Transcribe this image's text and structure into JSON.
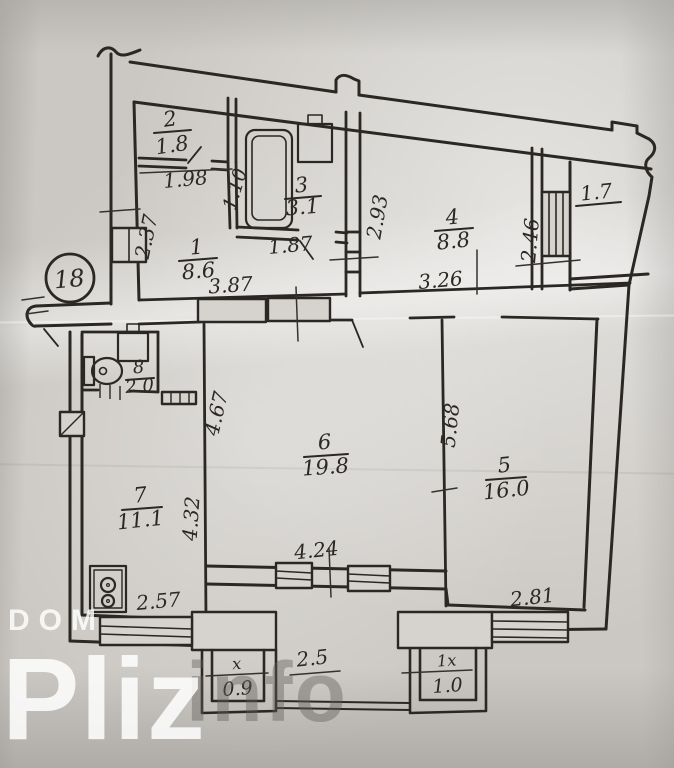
{
  "plan": {
    "unit_badge": "18",
    "rooms": [
      {
        "number": "1",
        "area": "8.6"
      },
      {
        "number": "2",
        "area": "1.8"
      },
      {
        "number": "3",
        "area": "3.1"
      },
      {
        "number": "4",
        "area": "8.8"
      },
      {
        "number": "5",
        "area": "16.0"
      },
      {
        "number": "6",
        "area": "19.8"
      },
      {
        "number": "7",
        "area": "11.1"
      },
      {
        "number": "8",
        "area": "2.0"
      }
    ],
    "pantry_area": "1.7",
    "balconies": [
      {
        "label": "x",
        "area": "0.9"
      },
      {
        "label": "1x",
        "area": "1.0"
      }
    ],
    "balcony_width": "2.5",
    "dimensions": {
      "d1_98": "1.98",
      "d1_10": "1.10",
      "d1_87": "1.87",
      "d2_37": "2.37",
      "d2_93": "2.93",
      "d2_46": "2.46",
      "d3_26": "3.26",
      "d3_87": "3.87",
      "d4_67": "4.67",
      "d5_68": "5.68",
      "d4_32": "4.32",
      "d4_24": "4.24",
      "d2_57": "2.57",
      "d2_81": "2.81"
    },
    "ink_color": "#2b2824",
    "paper_color": "#d6d3ce"
  },
  "watermark": {
    "brand_small": "DOM",
    "brand_large": "Pliz",
    "brand_suffix": "info"
  }
}
